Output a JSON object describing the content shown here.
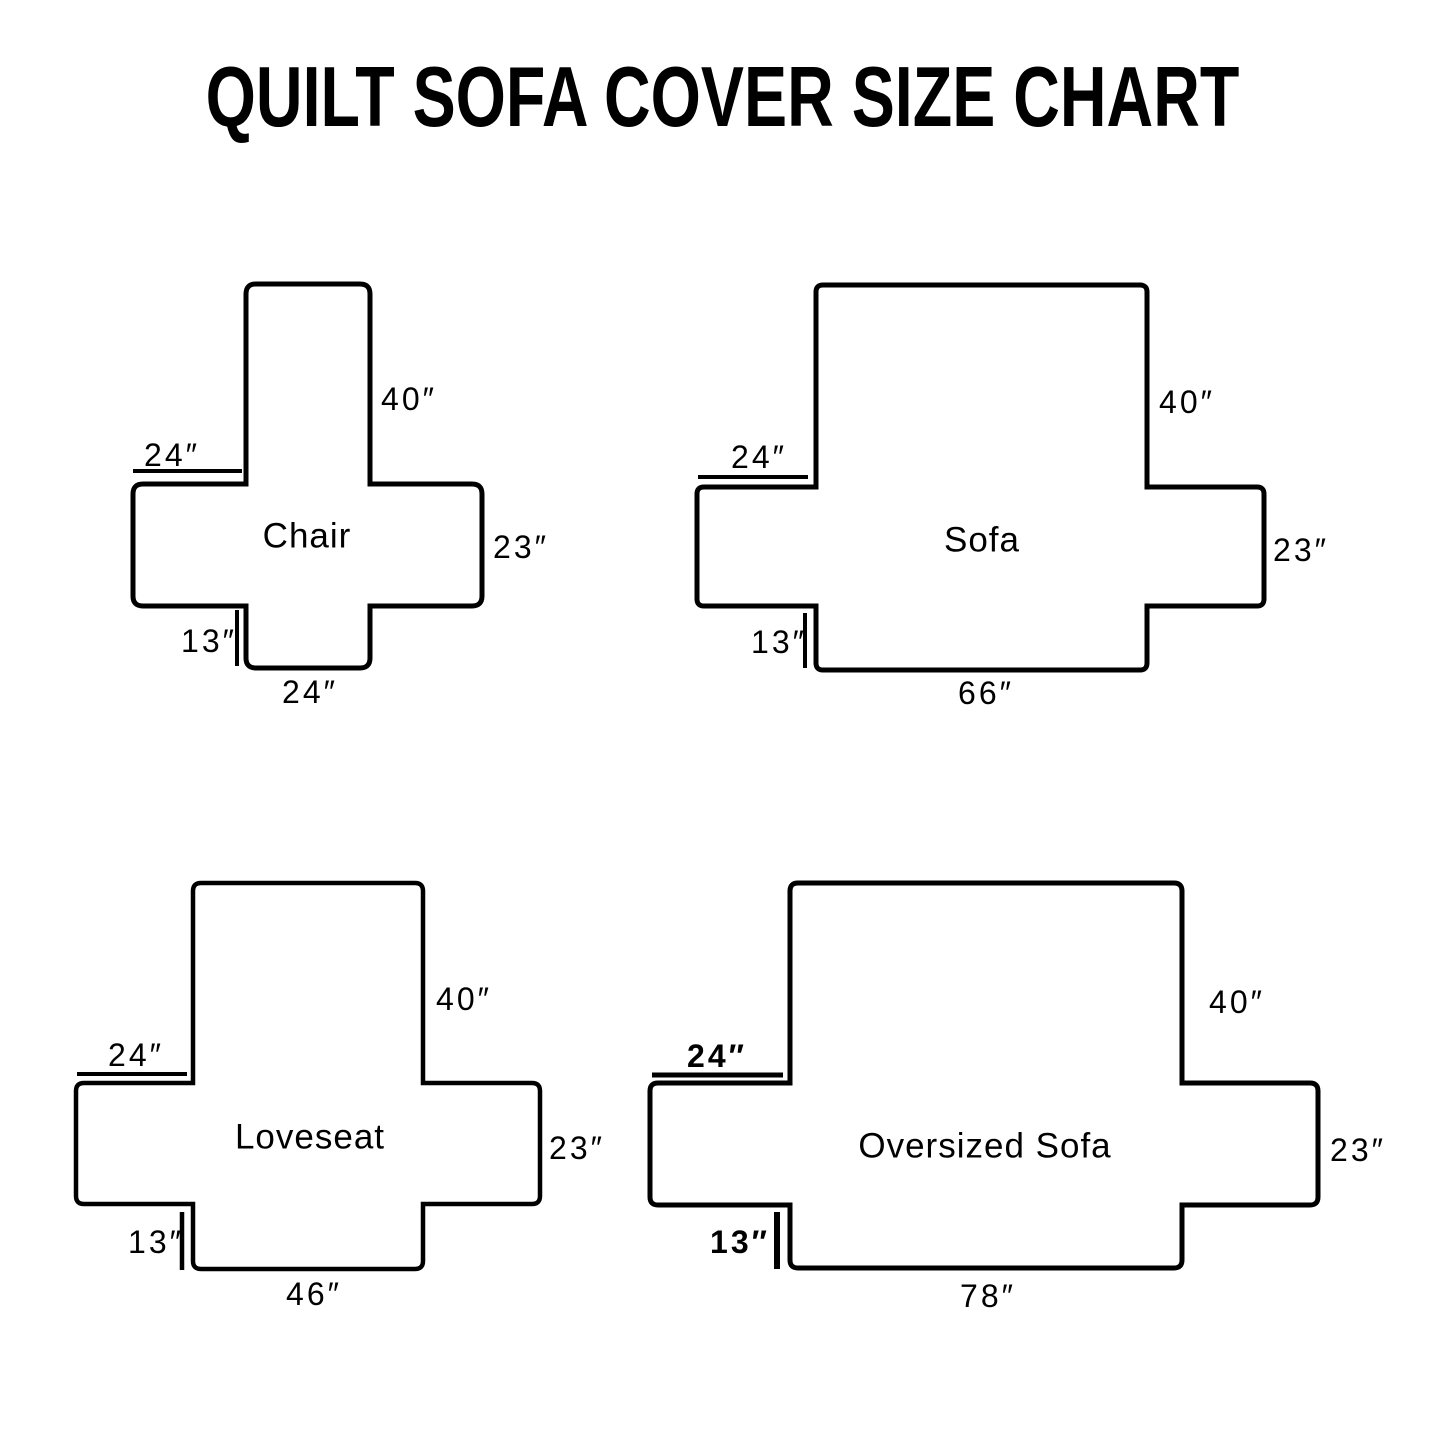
{
  "title": "QUILT SOFA COVER SIZE CHART",
  "colors": {
    "outline": "#000000",
    "background": "#ffffff",
    "text": "#000000"
  },
  "diagrams": [
    {
      "name": "Chair",
      "back_height": "40″",
      "arm_front_width": "24″",
      "arm_side_height": "23″",
      "front_skirt_drop": "13″",
      "seat_width": "24″"
    },
    {
      "name": "Sofa",
      "back_height": "40″",
      "arm_front_width": "24″",
      "arm_side_height": "23″",
      "front_skirt_drop": "13″",
      "seat_width": "66″"
    },
    {
      "name": "Loveseat",
      "back_height": "40″",
      "arm_front_width": "24″",
      "arm_side_height": "23″",
      "front_skirt_drop": "13″",
      "seat_width": "46″"
    },
    {
      "name": "Oversized Sofa",
      "back_height": "40″",
      "arm_front_width": "24″",
      "arm_side_height": "23″",
      "front_skirt_drop": "13″",
      "seat_width": "78″"
    }
  ]
}
